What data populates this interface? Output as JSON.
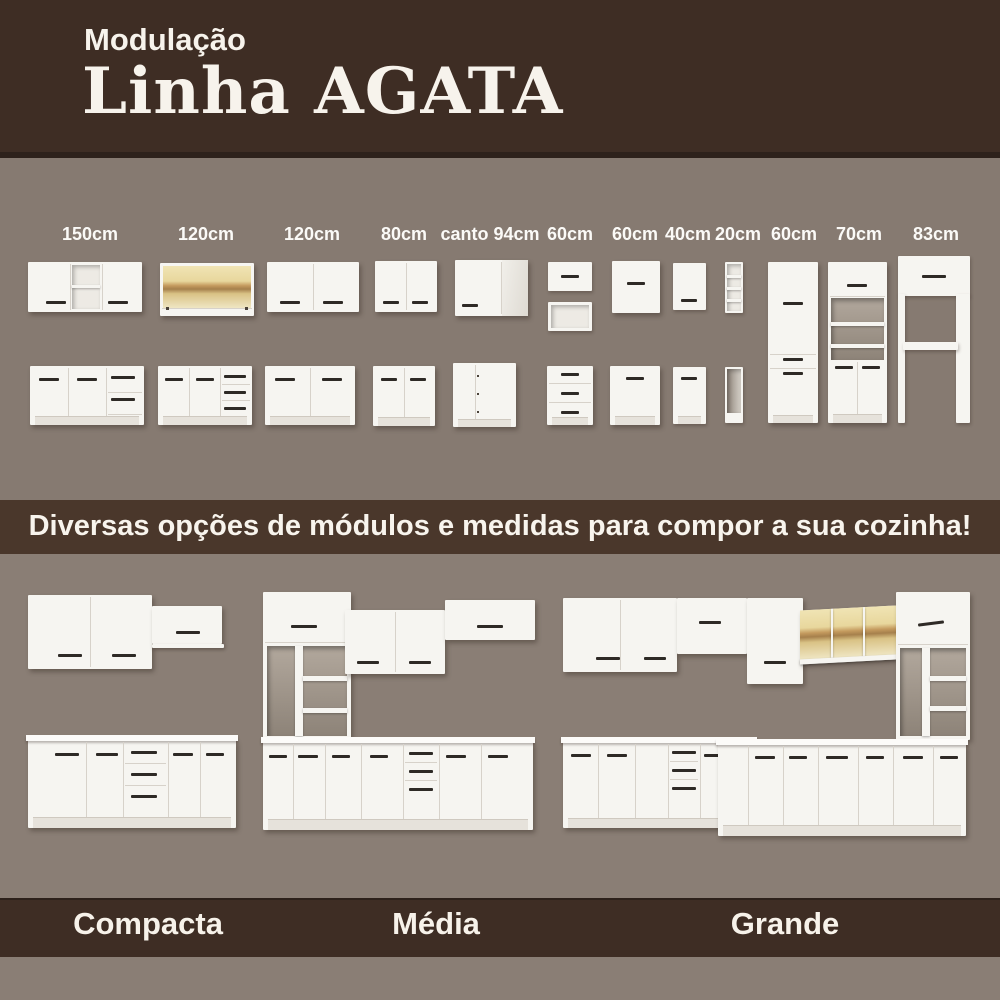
{
  "header": {
    "kicker": "Modulação",
    "title": "Linha AGATA"
  },
  "module_sizes": [
    "150cm",
    "120cm",
    "120cm",
    "80cm",
    "canto 94cm",
    "60cm",
    "60cm",
    "40cm",
    "20cm",
    "60cm",
    "70cm",
    "83cm"
  ],
  "banner": {
    "text": "Diversas opções de módulos e medidas para compor a sua cozinha!"
  },
  "kitchens": [
    {
      "name": "Compacta"
    },
    {
      "name": "Média"
    },
    {
      "name": "Grande"
    }
  ],
  "colors": {
    "header_bg": "#3E2D24",
    "header_edge": "#2D211B",
    "modules_bg": "#867A71",
    "banner_bg": "#4A372B",
    "kitchens_bg": "#8A7E75",
    "footer_bg": "#3E2D24",
    "text_light": "#F7F3EC",
    "cabinet": "#F6F5F1",
    "handle": "#2E2A26",
    "wood": "#E8D79D",
    "wood_streak": "#A6804C"
  }
}
